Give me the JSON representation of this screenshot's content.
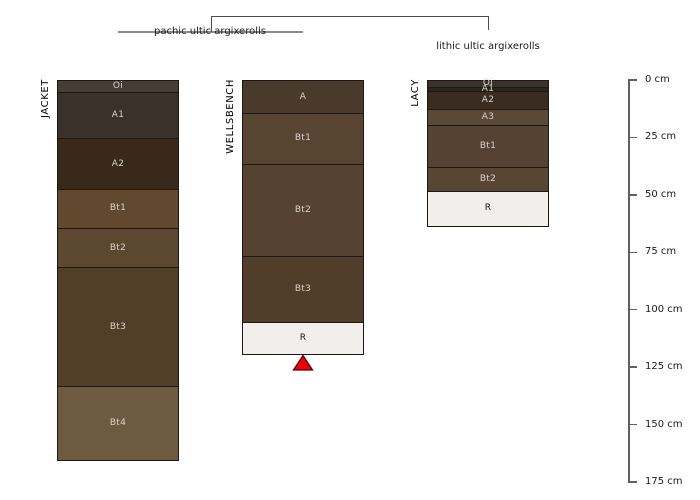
{
  "figure_type": "soil-profile-diagram",
  "taxonomy": {
    "pachic": "pachic ultic argixerolls",
    "lithic": "lithic ultic argixerolls"
  },
  "depth_axis": {
    "unit": "cm",
    "min_cm": 0,
    "max_cm": 175,
    "tick_interval_cm": 25,
    "tick_labels": [
      "0 cm",
      "25 cm",
      "50 cm",
      "75 cm",
      "100 cm",
      "125 cm",
      "150 cm",
      "175 cm"
    ]
  },
  "profiles": [
    {
      "name": "JACKET",
      "taxon": "pachic ultic argixerolls",
      "horizons": [
        {
          "label": "Oi",
          "top_cm": 0,
          "bottom_cm": 5,
          "color": "#463d35"
        },
        {
          "label": "A1",
          "top_cm": 5,
          "bottom_cm": 25,
          "color": "#3a312a"
        },
        {
          "label": "A2",
          "top_cm": 25,
          "bottom_cm": 47,
          "color": "#38291b"
        },
        {
          "label": "Bt1",
          "top_cm": 47,
          "bottom_cm": 64,
          "color": "#60492e"
        },
        {
          "label": "Bt2",
          "top_cm": 64,
          "bottom_cm": 81,
          "color": "#5c4830"
        },
        {
          "label": "Bt3",
          "top_cm": 81,
          "bottom_cm": 133,
          "color": "#523f2a"
        },
        {
          "label": "Bt4",
          "top_cm": 133,
          "bottom_cm": 165,
          "color": "#6e5a40"
        }
      ]
    },
    {
      "name": "WELLSBENCH",
      "taxon": "pachic ultic argixerolls",
      "marker": "red-triangle",
      "horizons": [
        {
          "label": "A",
          "top_cm": 0,
          "bottom_cm": 14,
          "color": "#4a3a2b"
        },
        {
          "label": "Bt1",
          "top_cm": 14,
          "bottom_cm": 36,
          "color": "#574431"
        },
        {
          "label": "Bt2",
          "top_cm": 36,
          "bottom_cm": 76,
          "color": "#554230"
        },
        {
          "label": "Bt3",
          "top_cm": 76,
          "bottom_cm": 105,
          "color": "#513e2a"
        },
        {
          "label": "R",
          "top_cm": 105,
          "bottom_cm": 119,
          "color": "#f0efec",
          "text_color": "#1a1a1a"
        }
      ]
    },
    {
      "name": "LACY",
      "taxon": "lithic ultic argixerolls",
      "horizons": [
        {
          "label": "Oi",
          "top_cm": 0,
          "bottom_cm": 2.5,
          "color": "#3a322b"
        },
        {
          "label": "A1",
          "top_cm": 2.5,
          "bottom_cm": 4.5,
          "color": "#2c241c"
        },
        {
          "label": "A2",
          "top_cm": 4.5,
          "bottom_cm": 12,
          "color": "#3a2c20"
        },
        {
          "label": "A3",
          "top_cm": 12,
          "bottom_cm": 19,
          "color": "#5b4836"
        },
        {
          "label": "Bt1",
          "top_cm": 19,
          "bottom_cm": 37.5,
          "color": "#564233"
        },
        {
          "label": "Bt2",
          "top_cm": 37.5,
          "bottom_cm": 48,
          "color": "#594533"
        },
        {
          "label": "R",
          "top_cm": 48,
          "bottom_cm": 63,
          "color": "#f0efec",
          "text_color": "#1a1a1a"
        }
      ]
    }
  ],
  "colors": {
    "background": "#ffffff",
    "band_border": "#1f1812",
    "horizon_label": "#d9d3ca",
    "bracket_dark": "#4d4d4d",
    "bracket_light": "#8c8c8c",
    "axis": "#606060",
    "marker_fill": "#e8000b",
    "marker_stroke": "#5a0000"
  }
}
